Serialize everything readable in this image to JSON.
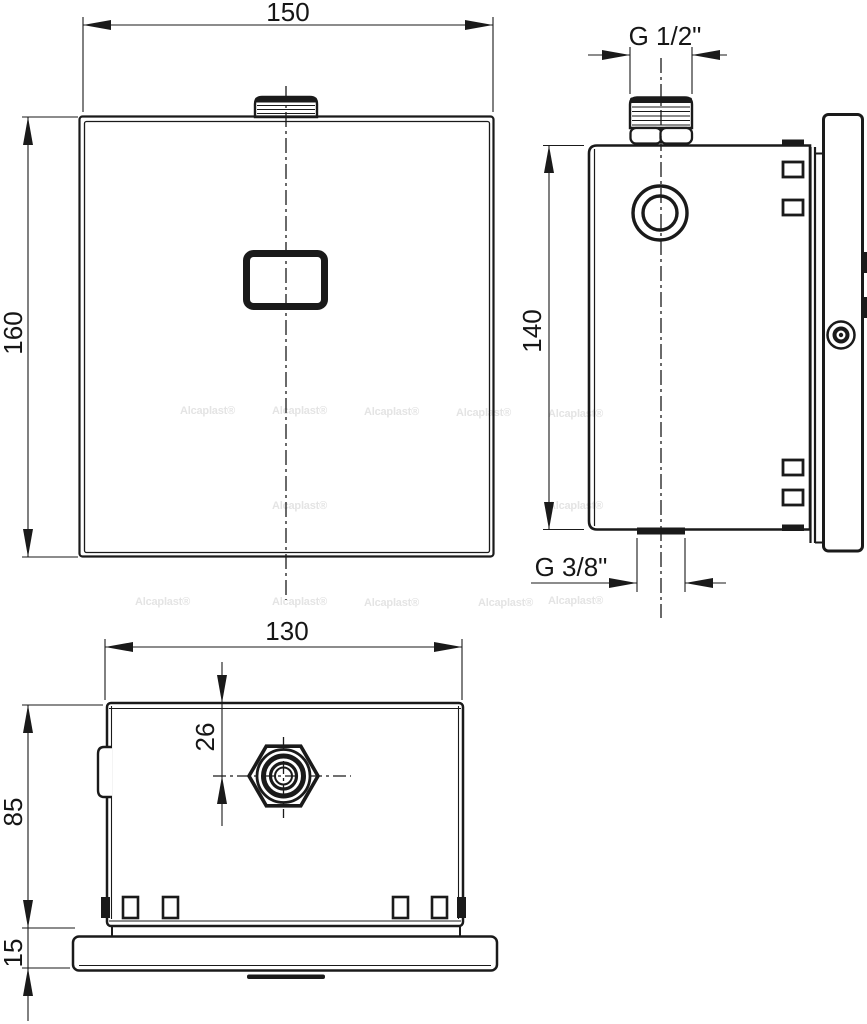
{
  "drawing": {
    "type": "technical-orthographic-views",
    "views": [
      "front",
      "side",
      "bottom"
    ]
  },
  "labels": {
    "front_width": "150",
    "front_height": "160",
    "side_top_thread": "G 1/2\"",
    "side_height": "140",
    "side_bottom_thread": "G 3/8\"",
    "bottom_width": "130",
    "bottom_offset": "26",
    "bottom_depth": "85",
    "base_height": "15"
  },
  "watermark": {
    "text": "Alcaplast®"
  },
  "colors": {
    "line": "#1a1a1a",
    "background": "#ffffff",
    "watermark": "#e4e4e4"
  }
}
